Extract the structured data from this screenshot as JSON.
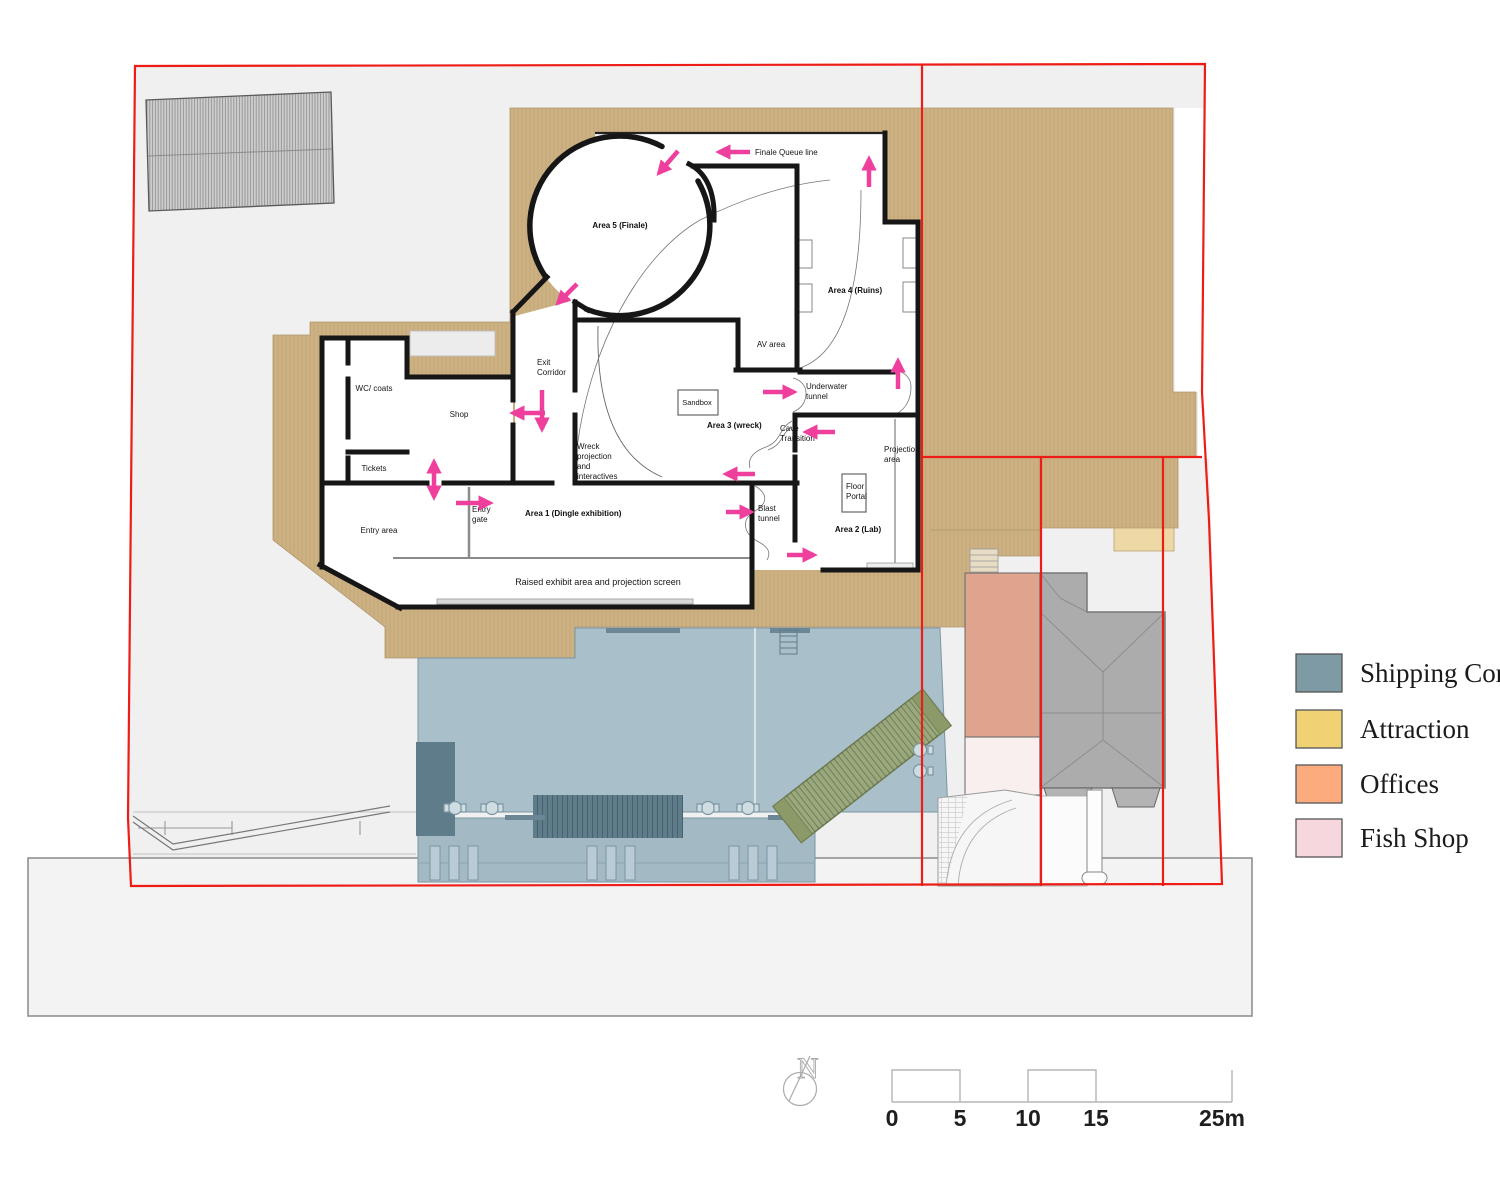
{
  "title": "Attraction ground floor site plan",
  "legend": {
    "items": [
      {
        "label": "Shipping Container",
        "color": "#7e9aa4"
      },
      {
        "label": "Attraction",
        "color": "#f0d173"
      },
      {
        "label": "Offices",
        "color": "#fbab7e"
      },
      {
        "label": "Fish Shop",
        "color": "#f6d7de"
      }
    ]
  },
  "scale_bar": {
    "labels": [
      "0",
      "5",
      "10",
      "15",
      "25m"
    ]
  },
  "compass": {
    "label": "N"
  },
  "plan": {
    "areas": {
      "area1": "Area 1 (Dingle exhibition)",
      "area2": "Area 2 (Lab)",
      "area3": "Area 3 (wreck)",
      "area4": "Area 4 (Ruins)",
      "area5": "Area 5 (Finale)"
    },
    "rooms": {
      "wc": "WC/ coats",
      "tickets": "Tickets",
      "shop": "Shop",
      "exit_corridor": "Exit\nCorridor",
      "entry_area": "Entry area",
      "entry_gate": "Entry\ngate",
      "finale_queue": "Finale Queue line",
      "av": "AV area",
      "underwater": "Underwater\ntunnel",
      "sandbox": "Sandbox",
      "wreck_proj": "Wreck\nprojection\nand\ninteractives",
      "cave": "Cave\nTransition",
      "projection": "Projection\narea",
      "floor_portal": "Floor\nPortal",
      "blast": "Blast\ntunnel",
      "raised": "Raised exhibit area and projection screen"
    },
    "colors": {
      "attraction_fill": "#ccb183",
      "attraction_pale": "#eed9a6",
      "shipping_fill": "#a9bfc9",
      "shipping_dark": "#5e7c8a",
      "container_khaki": "#9aa87a",
      "offices_fill": "#dfa48d",
      "fish_shop_fill": "#f8efee",
      "site_gray": "#f0f0f0",
      "boundary_red": "#ee1c16",
      "arrow_pink": "#ee3f9d",
      "wall_black": "#161616"
    }
  }
}
